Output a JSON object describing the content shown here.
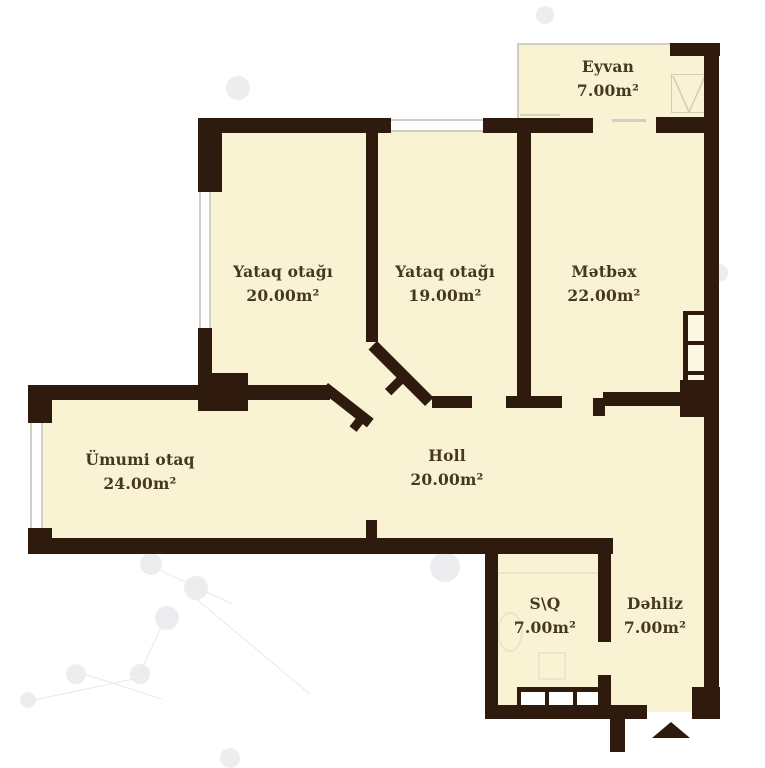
{
  "plan": {
    "rooms": [
      {
        "id": "eyvan",
        "name": "Eyvan",
        "area": "7.00m²"
      },
      {
        "id": "yataq1",
        "name": "Yataq otağı",
        "area": "20.00m²"
      },
      {
        "id": "yataq2",
        "name": "Yataq otağı",
        "area": "19.00m²"
      },
      {
        "id": "metbex",
        "name": "Mətbəx",
        "area": "22.00m²"
      },
      {
        "id": "umumi",
        "name": "Ümumi otaq",
        "area": "24.00m²"
      },
      {
        "id": "holl",
        "name": "Holl",
        "area": "20.00m²"
      },
      {
        "id": "sq",
        "name": "S\\Q",
        "area": "7.00m²"
      },
      {
        "id": "dehliz",
        "name": "Dəhliz",
        "area": "7.00m²"
      }
    ],
    "colors": {
      "wall": "#2e1b0e",
      "floor": "#f9f3d4",
      "label": "#473722",
      "window": "#cfcfc8",
      "background": "#ffffff"
    },
    "entrance_marker": "up-arrow"
  }
}
